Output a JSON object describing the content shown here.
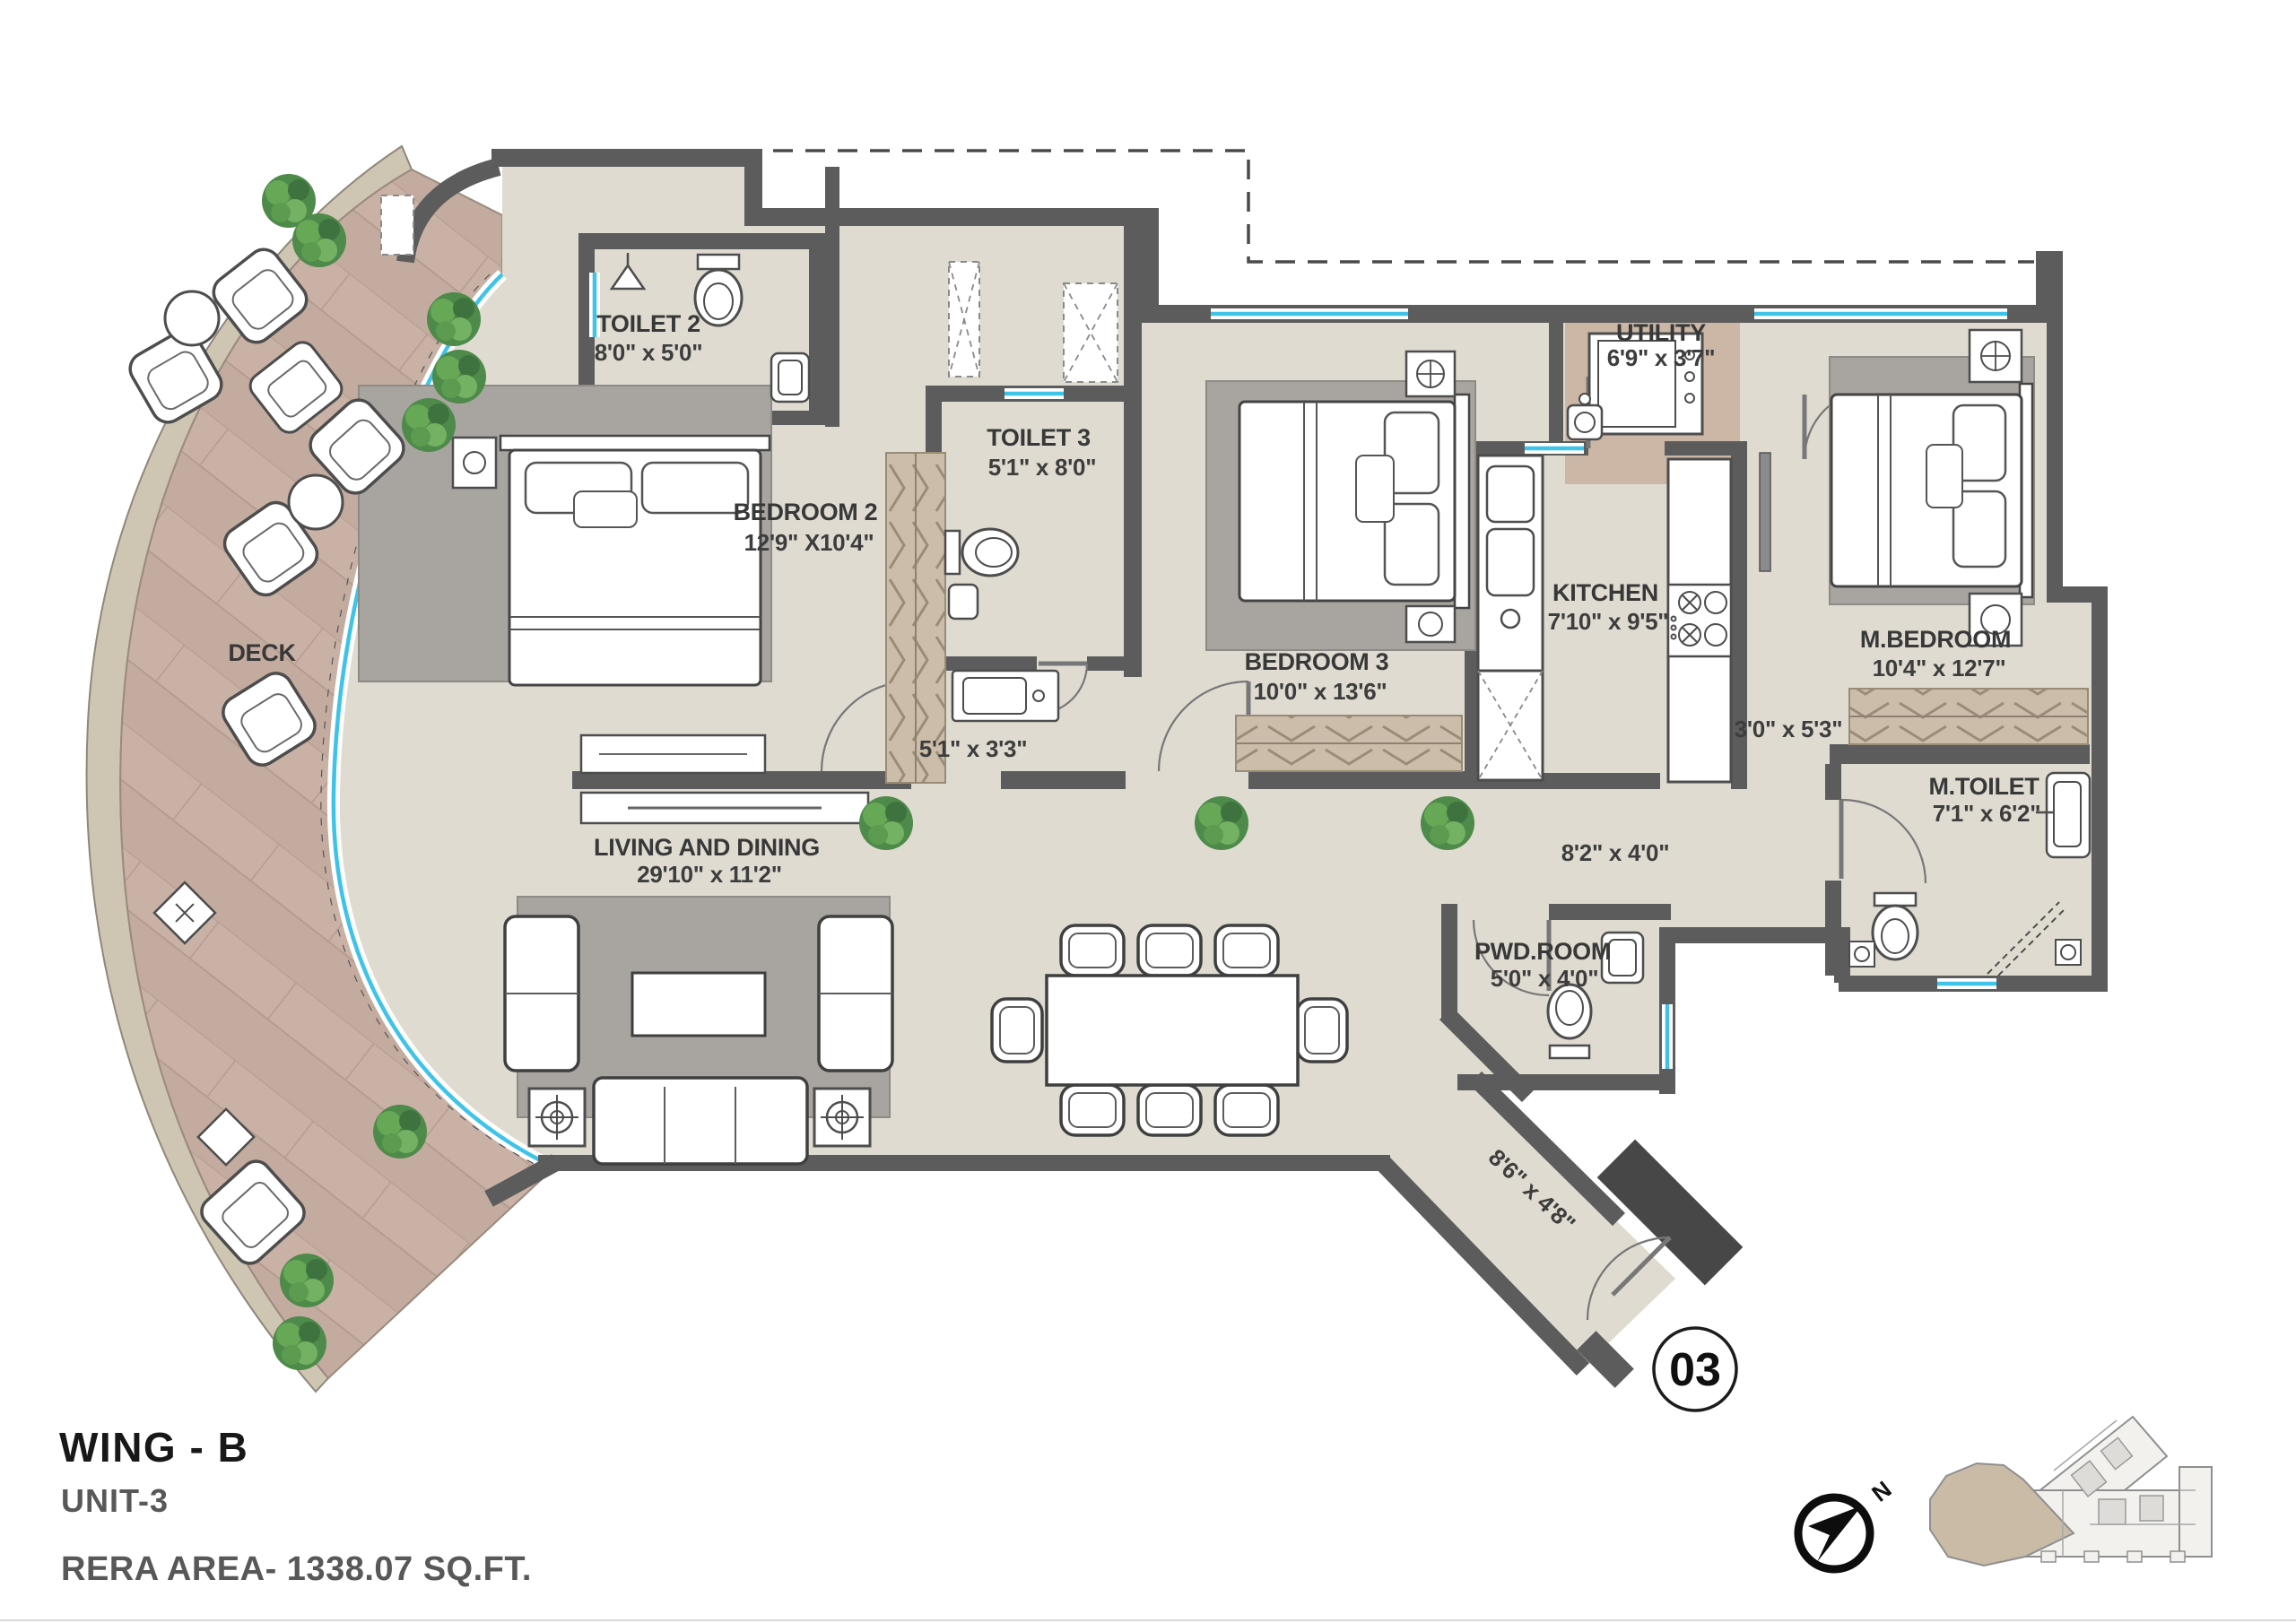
{
  "title_block": {
    "wing": "WING - B",
    "unit": "UNIT-3",
    "rera_area": "RERA AREA- 1338.07 SQ.FT."
  },
  "entry_badge": {
    "number": "03"
  },
  "compass": {
    "north_label": "N"
  },
  "rooms": {
    "deck": {
      "name": "DECK",
      "dim": ""
    },
    "toilet2": {
      "name": "TOILET 2",
      "dim": "8'0\" x 5'0\""
    },
    "bedroom2": {
      "name": "BEDROOM 2",
      "dim": "12'9\" X10'4\""
    },
    "toilet3": {
      "name": "TOILET 3",
      "dim": "5'1\" x 8'0\""
    },
    "bedroom3": {
      "name": "BEDROOM 3",
      "dim": "10'0\" x 13'6\""
    },
    "utility": {
      "name": "UTILITY",
      "dim": "6'9\" x 3'7\""
    },
    "kitchen": {
      "name": "KITCHEN",
      "dim": "7'10\" x 9'5\""
    },
    "master_bedroom": {
      "name": "M.BEDROOM",
      "dim": "10'4\" x 12'7\""
    },
    "master_toilet": {
      "name": "M.TOILET",
      "dim": "7'1\" x 6'2\""
    },
    "powder_room": {
      "name": "PWD.ROOM",
      "dim": "5'0\" x 4'0\""
    },
    "living_dining": {
      "name": "LIVING AND DINING",
      "dim": "29'10\" x 11'2\""
    }
  },
  "passages": {
    "inner_lobby": {
      "dim": "5'1\" x 3'3\""
    },
    "master_lobby": {
      "dim": "3'0\" x 5'3\""
    },
    "rear_passage": {
      "dim": "8'2\" x 4'0\""
    },
    "entry_foyer": {
      "dim": "8'6\" x 4'8\""
    }
  },
  "colors": {
    "wall": "#5c5c5c",
    "dark_wall": "#474747",
    "floor": "#dfdbd1",
    "deck_wood": "#c4ab9f",
    "deck_band": "#cec5b3",
    "utility_floor": "#ccb6a6",
    "wardrobe": "#cbbda9",
    "rug": "#a8a5a0",
    "glass_window": "#3fc3e8",
    "plant_green": "#4e8a4a"
  }
}
